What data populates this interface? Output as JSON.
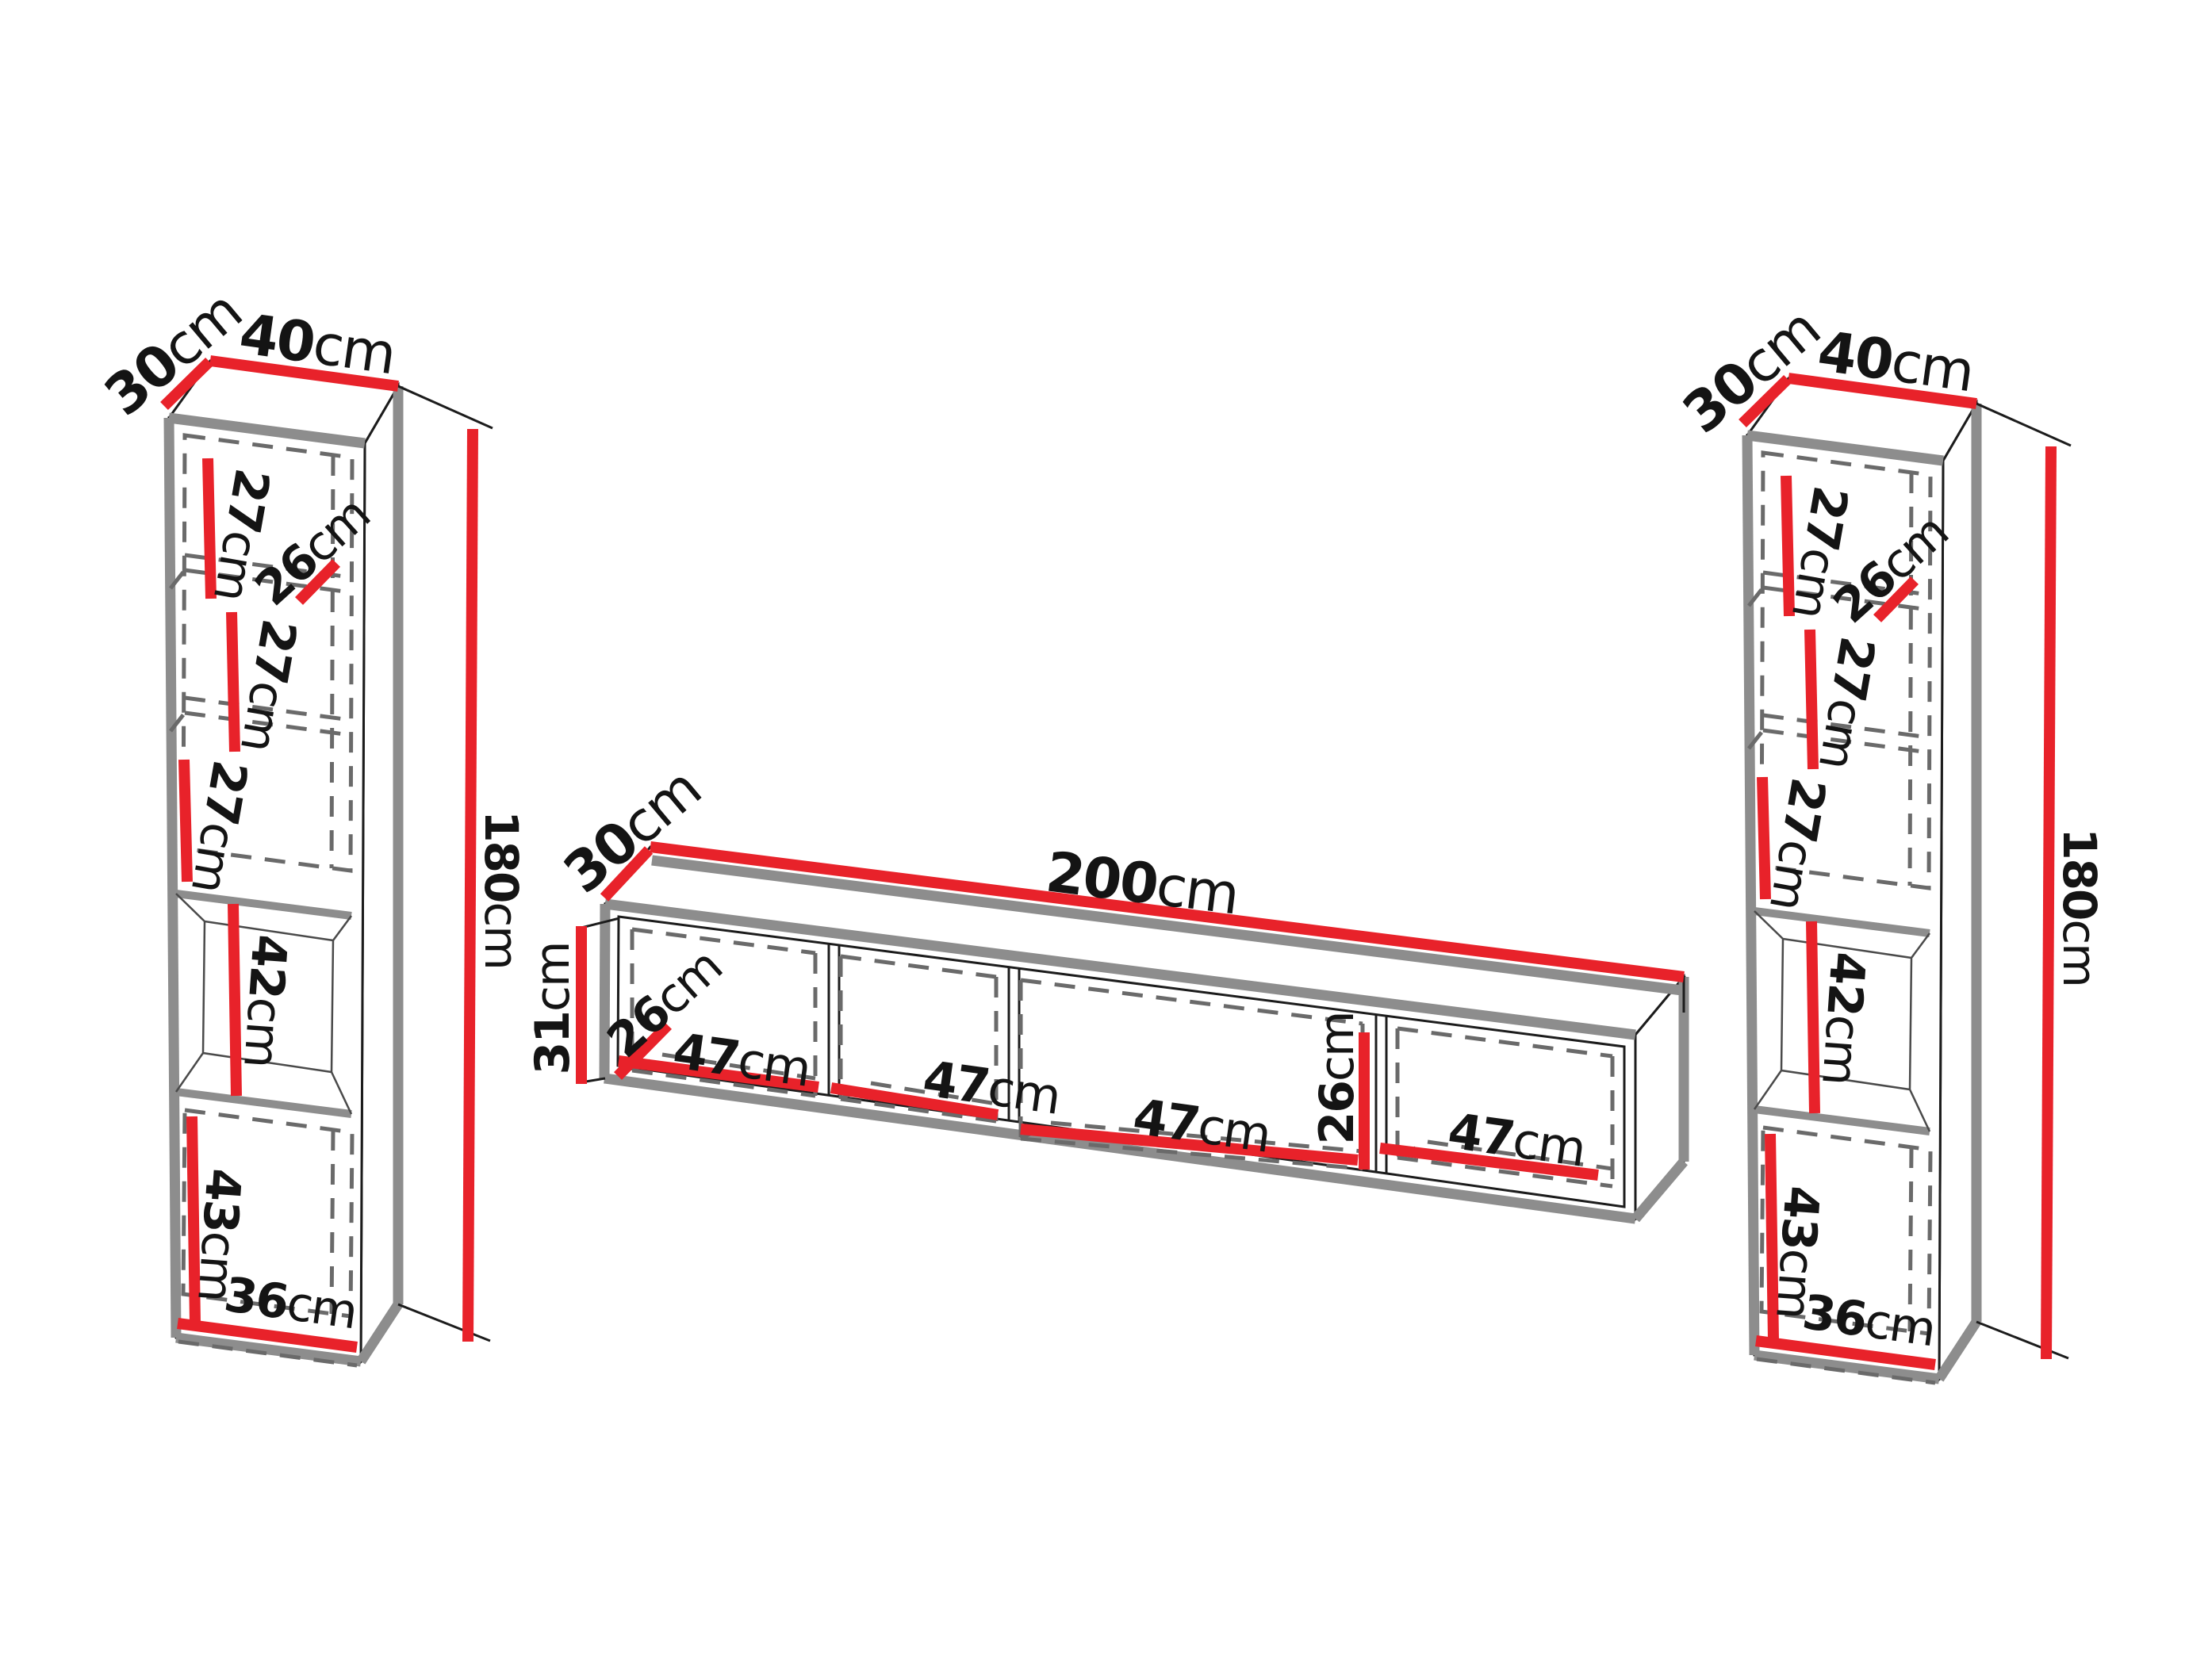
{
  "diagram_title": "wall unit dimensions diagram",
  "colors": {
    "dimension_red": "#e8222a",
    "outline_gray": "#8d8d8d",
    "line_black": "#1c1c1c",
    "dash_gray": "#6a6a6a",
    "background": "#ffffff",
    "text": "#141414"
  },
  "pieces": {
    "left_cabinet": {
      "depth": {
        "value": "30",
        "unit": "cm"
      },
      "width": {
        "value": "40",
        "unit": "cm"
      },
      "height": {
        "value": "180",
        "unit": "cm"
      },
      "top_shelf": {
        "value": "27",
        "unit": "cm"
      },
      "shelf_depth": {
        "value": "26",
        "unit": "cm"
      },
      "middle_shelf": {
        "value": "27",
        "unit": "cm"
      },
      "lower_shelf": {
        "value": "27",
        "unit": "cm"
      },
      "open_niche": {
        "value": "42",
        "unit": "cm"
      },
      "bottom_cabinet": {
        "value": "43",
        "unit": "cm"
      },
      "inner_width": {
        "value": "36",
        "unit": "cm"
      }
    },
    "tv_stand": {
      "depth": {
        "value": "30",
        "unit": "cm"
      },
      "width": {
        "value": "200",
        "unit": "cm"
      },
      "height": {
        "value": "31",
        "unit": "cm"
      },
      "compartment_depth": {
        "value": "26",
        "unit": "cm"
      },
      "inner_height": {
        "value": "26",
        "unit": "cm"
      },
      "compartment_1": {
        "value": "47",
        "unit": "cm"
      },
      "compartment_2": {
        "value": "47",
        "unit": "cm"
      },
      "compartment_3": {
        "value": "47",
        "unit": "cm"
      },
      "compartment_4": {
        "value": "47",
        "unit": "cm"
      }
    },
    "right_cabinet": {
      "depth": {
        "value": "30",
        "unit": "cm"
      },
      "width": {
        "value": "40",
        "unit": "cm"
      },
      "height": {
        "value": "180",
        "unit": "cm"
      },
      "top_shelf": {
        "value": "27",
        "unit": "cm"
      },
      "shelf_depth": {
        "value": "26",
        "unit": "cm"
      },
      "middle_shelf": {
        "value": "27",
        "unit": "cm"
      },
      "lower_shelf": {
        "value": "27",
        "unit": "cm"
      },
      "open_niche": {
        "value": "42",
        "unit": "cm"
      },
      "bottom_cabinet": {
        "value": "43",
        "unit": "cm"
      },
      "inner_width": {
        "value": "36",
        "unit": "cm"
      }
    }
  }
}
